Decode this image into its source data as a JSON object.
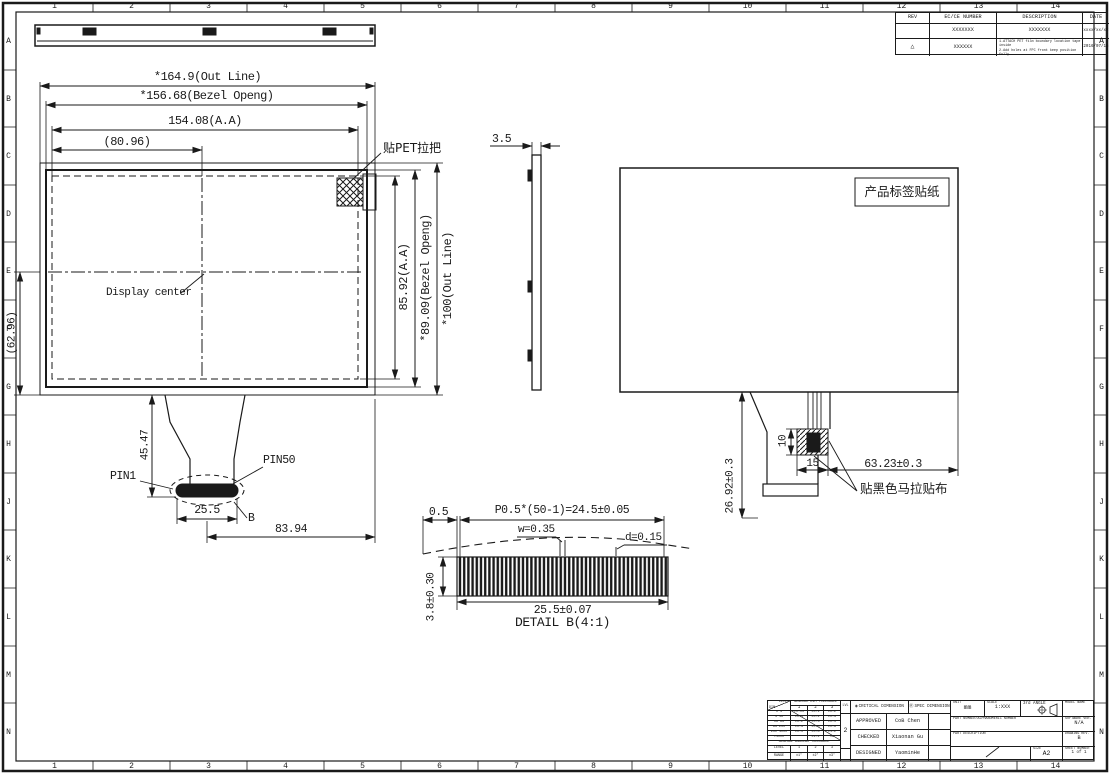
{
  "colors": {
    "line": "#1a1a1a",
    "paper": "#ffffff"
  },
  "sheet": {
    "cols": [
      "1",
      "2",
      "3",
      "4",
      "5",
      "6",
      "7",
      "8",
      "9",
      "10",
      "11",
      "12",
      "13",
      "14"
    ],
    "rows": [
      "A",
      "B",
      "C",
      "D",
      "E",
      "F",
      "G",
      "H",
      "J",
      "K",
      "L",
      "M",
      "N"
    ]
  },
  "revision_table": {
    "headers": {
      "rev": "REV",
      "ec": "EC/CE NUMBER",
      "desc": "DESCRIPTION",
      "date": "DATE"
    },
    "rows": [
      {
        "rev": "",
        "ec": "XXXXXXX",
        "desc": "XXXXXXX",
        "date": "xxxx/xx/xx"
      },
      {
        "rev": "△",
        "ec": "XXXXXX",
        "desc": "1.ATTACH PET film boundary location tape inside\n2.Add holes at FPC front keep position fully\nburn upon disconnected two chip point",
        "date": "2016/07/16"
      }
    ]
  },
  "front_view": {
    "out_line_w": "*164.9(Out Line)",
    "bezel_w": "*156.68(Bezel Openg)",
    "aa_w": "154.08(A.A)",
    "center_x": "(80.96)",
    "aa_h": "85.92(A.A)",
    "bezel_h": "*89.09(Bezel Openg)",
    "out_line_h": "*100(Out Line)",
    "left_ref": "(62.96)",
    "display_center": "Display center",
    "pet_tab": "贴PET拉把",
    "pin1": "PIN1",
    "pin50": "PIN50",
    "fpc_drop": "45.47",
    "conn_w": "25.5",
    "detail_ref": "B",
    "conn_offset": "83.94"
  },
  "side_view": {
    "thickness": "3.5"
  },
  "rear_view": {
    "sticker": "产品标签贴纸",
    "mylar": "贴黑色马拉贴布",
    "tab_h": "10",
    "tab_w": "15",
    "offset": "63.23±0.3",
    "fpc_len": "26.92±0.3"
  },
  "detail_b": {
    "edge": "0.5",
    "pitch": "P0.5*(50-1)=24.5±0.05",
    "pin_w": "w=0.35",
    "pin_d": "d=0.15",
    "width": "25.5±0.07",
    "height": "3.8±0.30",
    "title": "DETAIL B(4:1)"
  },
  "title_block": {
    "tol": {
      "corner_top": "LEVEL",
      "corner_bottom": "DIM",
      "dim_header": "GENERAL DIM TOLERANCE",
      "levels": [
        "1",
        "2",
        "3"
      ],
      "rows": [
        [
          "0~4",
          "±0.05",
          "±0.1",
          "±0.2"
        ],
        [
          "4~16",
          "±0.1",
          "±0.2",
          "±0.3"
        ],
        [
          "16~63",
          "±0.2",
          "±0.3",
          "±0.5"
        ],
        [
          "63~250",
          "±0.3",
          "±0.5",
          "±0.8"
        ],
        [
          "250~1000",
          "±0.5",
          "±0.8",
          "±1.2"
        ],
        [
          ">1000",
          "",
          "±1.2",
          "±2"
        ]
      ],
      "ang_header": "GENERAL ANGULAR TOLERANCE",
      "ang_rows": [
        [
          "LEVEL",
          "1",
          "2",
          "3"
        ],
        [
          "RANGE",
          "±1°",
          "±2°",
          "±3°"
        ]
      ],
      "apply_label": "LVL",
      "apply_value": "2"
    },
    "marks": {
      "critical_icon": "◉",
      "critical": "CRITICAL DIMENSION",
      "spec_icon": "Ⓡ",
      "spec": "SPEC DIMENSION"
    },
    "signoff": [
      {
        "role": "APPROVED",
        "name": "CoB Chen"
      },
      {
        "role": "CHECKED",
        "name": "Xiaonan Gu"
      },
      {
        "role": "DESIGNED",
        "name": "YaominHe"
      }
    ],
    "info": {
      "unit_label": "UNIT",
      "unit": "mm",
      "scale_label": "SCALE",
      "scale": "1:XXX",
      "angle_label": "3rd ANGLE",
      "model_label": "MODEL NAME",
      "part_number_label": "PART NUMBER/ALPHANUMERIC NUMBER",
      "software_label": "SOFTWARE VER.",
      "software": "N/A",
      "part_desc_label": "PART DESCRIPTION",
      "rev_label": "DRAWING REV.",
      "rev": "B",
      "size_label": "SIZE",
      "size": "A2",
      "sheet_label": "SHEET NUMBER",
      "sheet": "1 of 1"
    }
  }
}
